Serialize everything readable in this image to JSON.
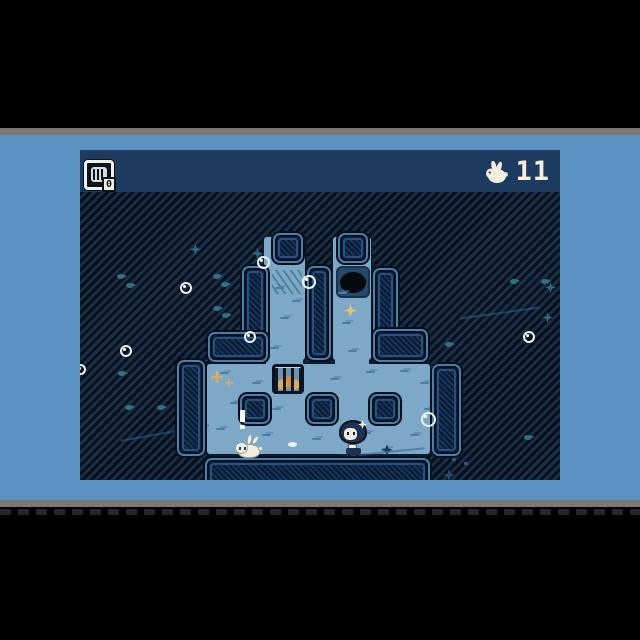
{
  "hud": {
    "cage_count": "0",
    "bunny_count": "11"
  },
  "colors": {
    "page_background": "#5c92c2",
    "separator_bar": "#7b7874",
    "water_path": "#7ea8c8",
    "deep_water": "#182f4c",
    "hud_band": "#1d3b5f",
    "hud_text": "#f3eedd",
    "gold_star": "#e7c468",
    "cage_contents_tan": "#dcab62"
  },
  "map": {
    "paths": [
      {
        "x": 182,
        "y": 43,
        "w": 45,
        "h": 127
      },
      {
        "x": 251,
        "y": 43,
        "w": 42,
        "h": 127
      },
      {
        "x": 125,
        "y": 170,
        "w": 227,
        "h": 94
      }
    ],
    "joints": [
      {
        "x": 186,
        "y": 166,
        "w": 37,
        "h": 8
      },
      {
        "x": 255,
        "y": 166,
        "w": 34,
        "h": 8
      }
    ],
    "walls": [
      {
        "x": 162,
        "y": 74,
        "w": 26,
        "h": 96
      },
      {
        "x": 128,
        "y": 140,
        "w": 60,
        "h": 30
      },
      {
        "x": 227,
        "y": 74,
        "w": 24,
        "h": 94
      },
      {
        "x": 293,
        "y": 76,
        "w": 25,
        "h": 94
      },
      {
        "x": 293,
        "y": 137,
        "w": 55,
        "h": 33
      },
      {
        "x": 97,
        "y": 168,
        "w": 28,
        "h": 96
      },
      {
        "x": 352,
        "y": 172,
        "w": 29,
        "h": 92
      },
      {
        "x": 125,
        "y": 266,
        "w": 225,
        "h": 32
      },
      {
        "x": 193,
        "y": 41,
        "w": 30,
        "h": 30
      },
      {
        "x": 258,
        "y": 41,
        "w": 30,
        "h": 30
      },
      {
        "x": 160,
        "y": 202,
        "w": 30,
        "h": 30
      },
      {
        "x": 227,
        "y": 202,
        "w": 30,
        "h": 30
      },
      {
        "x": 290,
        "y": 202,
        "w": 30,
        "h": 30
      }
    ],
    "hole": {
      "x": 256,
      "y": 74,
      "w": 34,
      "h": 32
    },
    "cage": {
      "x": 192,
      "y": 172,
      "w": 32,
      "h": 30
    },
    "bubbles": [
      {
        "x": 177,
        "y": 64,
        "s": 13
      },
      {
        "x": 222,
        "y": 83,
        "s": 14
      },
      {
        "x": 100,
        "y": 90,
        "s": 12
      },
      {
        "x": 164,
        "y": 139,
        "s": 12
      },
      {
        "x": 40,
        "y": 153,
        "s": 12
      },
      {
        "x": -5,
        "y": 172,
        "s": 11
      },
      {
        "x": 341,
        "y": 220,
        "s": 15
      },
      {
        "x": 443,
        "y": 139,
        "s": 12
      }
    ],
    "fish": [
      [
        37,
        82
      ],
      [
        46,
        91
      ],
      [
        133,
        82
      ],
      [
        141,
        90
      ],
      [
        133,
        114
      ],
      [
        142,
        121
      ],
      [
        38,
        179
      ],
      [
        45,
        213
      ],
      [
        77,
        213
      ],
      [
        365,
        150
      ],
      [
        430,
        87
      ],
      [
        461,
        87
      ],
      [
        444,
        243
      ]
    ],
    "teal_stars": [
      [
        110,
        52
      ],
      [
        172,
        56
      ],
      [
        465,
        90
      ],
      [
        462,
        120
      ]
    ],
    "navy_stars_on_path": [
      [
        301,
        252
      ]
    ],
    "navy_stars_on_hatch": [
      [
        363,
        277
      ]
    ],
    "gold_star": {
      "x": 264,
      "y": 112
    },
    "tan_sparkles": [
      {
        "x": 131,
        "y": 179,
        "size": "lg"
      },
      {
        "x": 145,
        "y": 187,
        "size": "sm"
      }
    ],
    "waves": [
      [
        195,
        95
      ],
      [
        200,
        125
      ],
      [
        190,
        155
      ],
      [
        212,
        108
      ],
      [
        262,
        130
      ],
      [
        268,
        158
      ],
      [
        258,
        100
      ],
      [
        140,
        180
      ],
      [
        172,
        190
      ],
      [
        212,
        180
      ],
      [
        250,
        186
      ],
      [
        286,
        179
      ],
      [
        320,
        178
      ],
      [
        340,
        190
      ],
      [
        150,
        210
      ],
      [
        192,
        216
      ],
      [
        242,
        212
      ],
      [
        312,
        210
      ],
      [
        344,
        216
      ],
      [
        136,
        236
      ],
      [
        182,
        242
      ],
      [
        232,
        246
      ],
      [
        282,
        240
      ],
      [
        330,
        242
      ],
      [
        302,
        256
      ]
    ],
    "scribble": {
      "x": 192,
      "y": 78
    },
    "caustics": [
      {
        "x": 215,
        "y": 262,
        "w": 130,
        "r": -6
      },
      {
        "x": 40,
        "y": 240,
        "w": 90,
        "r": -10
      },
      {
        "x": 380,
        "y": 120,
        "w": 80,
        "r": -8
      }
    ],
    "sand": {
      "x": 128,
      "y": 290,
      "w": 222
    },
    "specks": [
      [
        372,
        266
      ],
      [
        384,
        270
      ]
    ],
    "pebble": {
      "x": 208,
      "y": 250
    },
    "actors": {
      "exclamation": {
        "x": 160,
        "y": 218
      },
      "bunny": {
        "x": 155,
        "y": 244
      },
      "player": {
        "x": 258,
        "y": 226
      }
    }
  }
}
